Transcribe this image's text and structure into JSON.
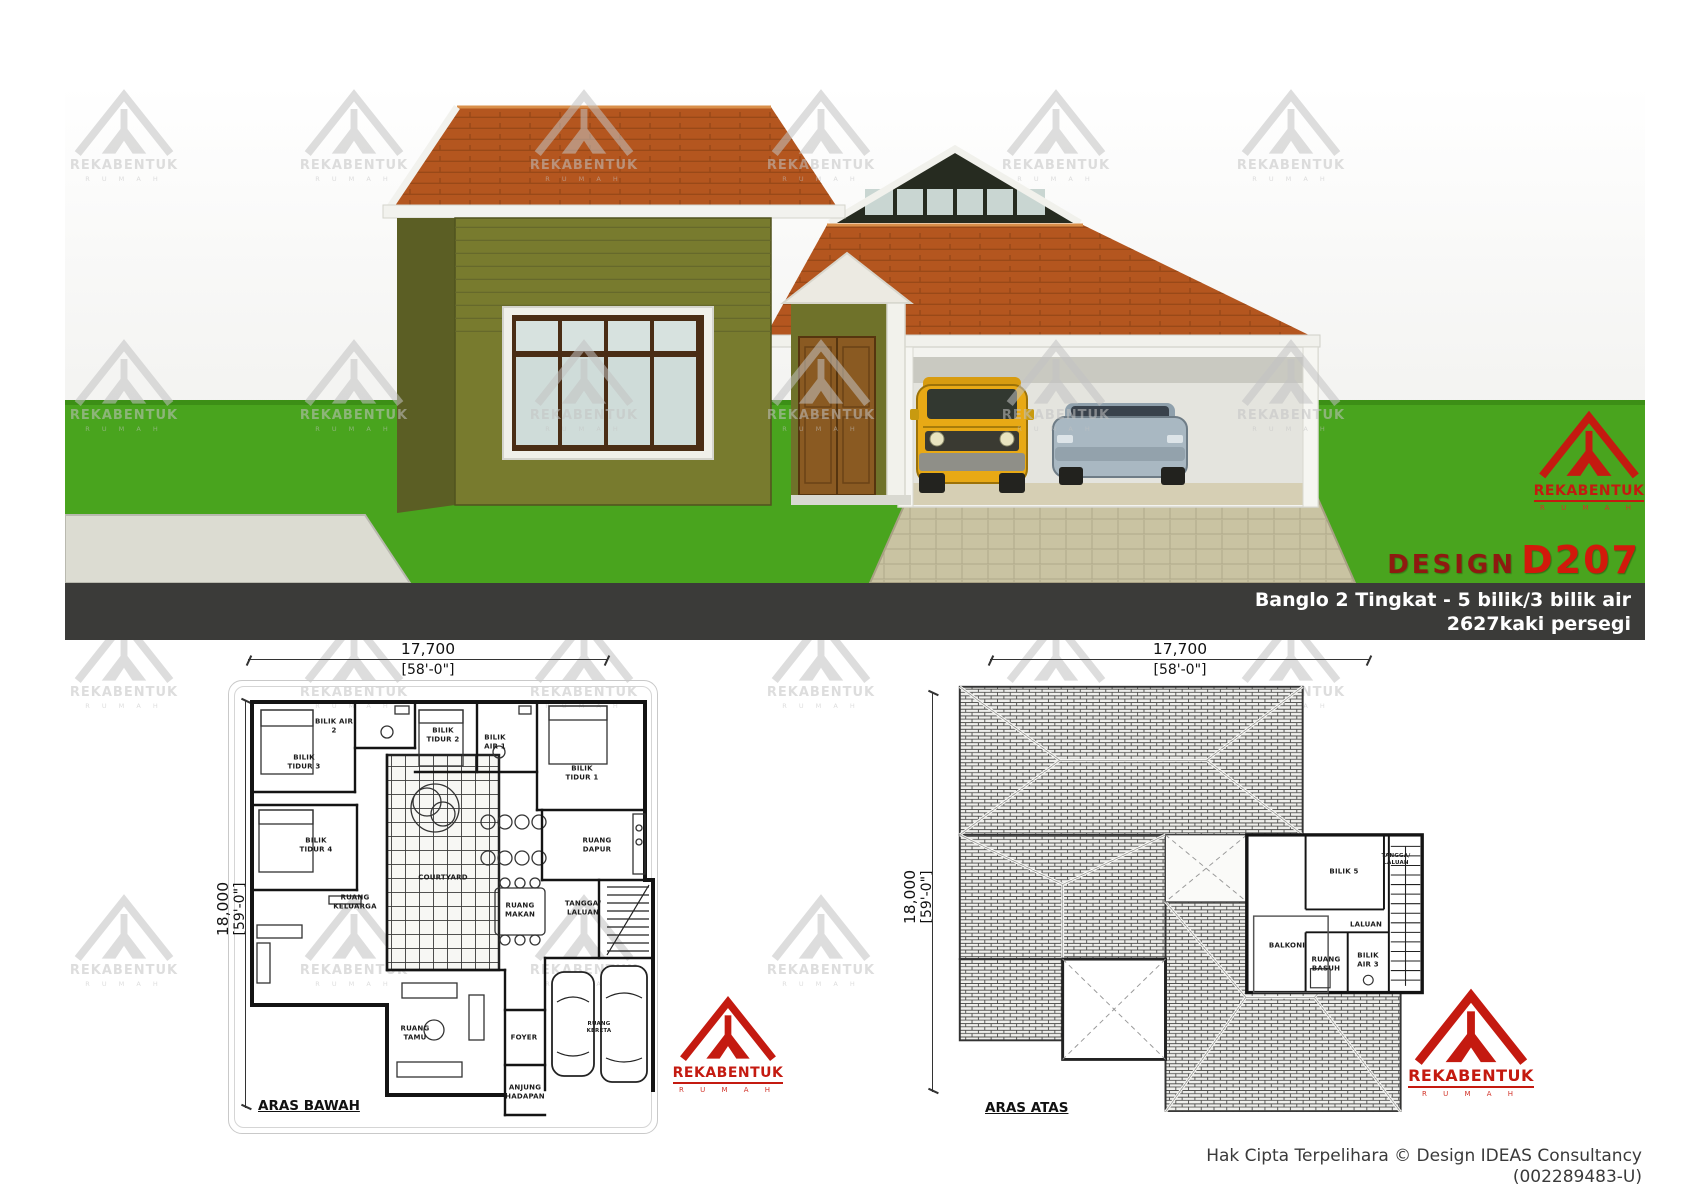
{
  "header": {
    "design_label": "DESIGN",
    "design_code": "D207",
    "subtitle_line1": "Banglo 2 Tingkat - 5 bilik/3 bilik air",
    "subtitle_line2": "2627kaki persegi"
  },
  "brand": {
    "name": "REKABENTUK",
    "tagline": "R U M A H"
  },
  "footer": {
    "copyright_line1": "Hak Cipta Terpelihara  © Design IDEAS Consultancy",
    "copyright_line2": "(002289483-U)"
  },
  "plan_bawah": {
    "title": "ARAS BAWAH",
    "dim_top_mm": "17,700",
    "dim_top_ft": "[58'-0\"]",
    "dim_side_mm": "18,000",
    "dim_side_ft": "[59'-0\"]",
    "rooms": {
      "tidur3": "BILIK TIDUR 3",
      "air2": "BILIK AIR 2",
      "tidur2": "BILIK TIDUR 2",
      "air1": "BILIK AIR 1",
      "tidur1": "BILIK TIDUR 1",
      "tidur4": "BILIK TIDUR 4",
      "keluarga": "RUANG KELUARGA",
      "courtyard": "COURTYARD",
      "dapur": "RUANG DAPUR",
      "makan": "RUANG MAKAN",
      "tangga": "TANGGA/ LALUAN",
      "tamu": "RUANG TAMU",
      "foyer": "FOYER",
      "anjung": "ANJUNG HADAPAN",
      "kereta": "RUANG KERETA"
    }
  },
  "plan_atas": {
    "title": "ARAS ATAS",
    "dim_top_mm": "17,700",
    "dim_top_ft": "[58'-0\"]",
    "dim_side_mm": "18,000",
    "dim_side_ft": "[59'-0\"]",
    "rooms": {
      "bilik5": "BILIK 5",
      "laluan": "LALUAN",
      "balkoni": "BALKONI",
      "basuh": "RUANG BASUH",
      "air3": "BILIK AIR 3",
      "tangga": "TANGGA/ LALUAN"
    }
  },
  "watermarks": {
    "positions": [
      [
        58,
        85
      ],
      [
        288,
        85
      ],
      [
        518,
        85
      ],
      [
        755,
        85
      ],
      [
        990,
        85
      ],
      [
        1225,
        85
      ],
      [
        58,
        335
      ],
      [
        288,
        335
      ],
      [
        518,
        335
      ],
      [
        755,
        335
      ],
      [
        990,
        335
      ],
      [
        1225,
        335
      ],
      [
        58,
        612
      ],
      [
        288,
        612
      ],
      [
        518,
        612
      ],
      [
        755,
        612
      ],
      [
        990,
        612
      ],
      [
        1225,
        612
      ],
      [
        58,
        890
      ],
      [
        288,
        890
      ],
      [
        518,
        890
      ],
      [
        755,
        890
      ],
      [
        990,
        890
      ],
      [
        1225,
        890
      ]
    ]
  },
  "colors": {
    "brand_red": "#c41a10",
    "design_dark_red": "#8e1a10",
    "design_code_red": "#d2190b",
    "bar_dark": "#3b3b39",
    "grass_green": "#49a41e",
    "wall_olive": "#787b2e",
    "roof_terracotta": "#b4561f"
  }
}
